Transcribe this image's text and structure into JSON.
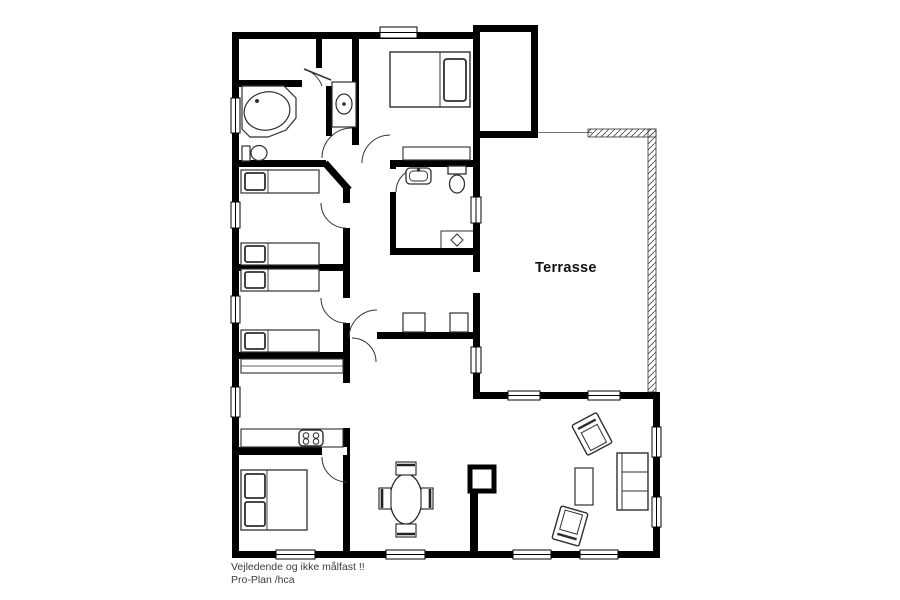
{
  "drawing": {
    "terrace_label": "Terrasse",
    "footer_note": "Vejledende og ikke målfast !!",
    "footer_credit": "Pro-Plan /hca"
  },
  "colors": {
    "walls": "#000000",
    "background": "#ffffff",
    "furniture_outline": "#2f2f2f",
    "railing_hatch": "#4d4d4d",
    "footer_text": "#3c3c3c"
  },
  "fixtures": [
    "bathtub",
    "toilet",
    "washbasin",
    "round-sink-fixture",
    "single-bed",
    "double-bed",
    "master-bed",
    "dresser",
    "wardrobe-cabinet",
    "kitchen-counter",
    "cooktop",
    "dining-table",
    "dining-chair",
    "sofa",
    "armchair",
    "coffee-table",
    "shower-drain",
    "fireplace",
    "terrace-railing",
    "window",
    "door-swing"
  ]
}
